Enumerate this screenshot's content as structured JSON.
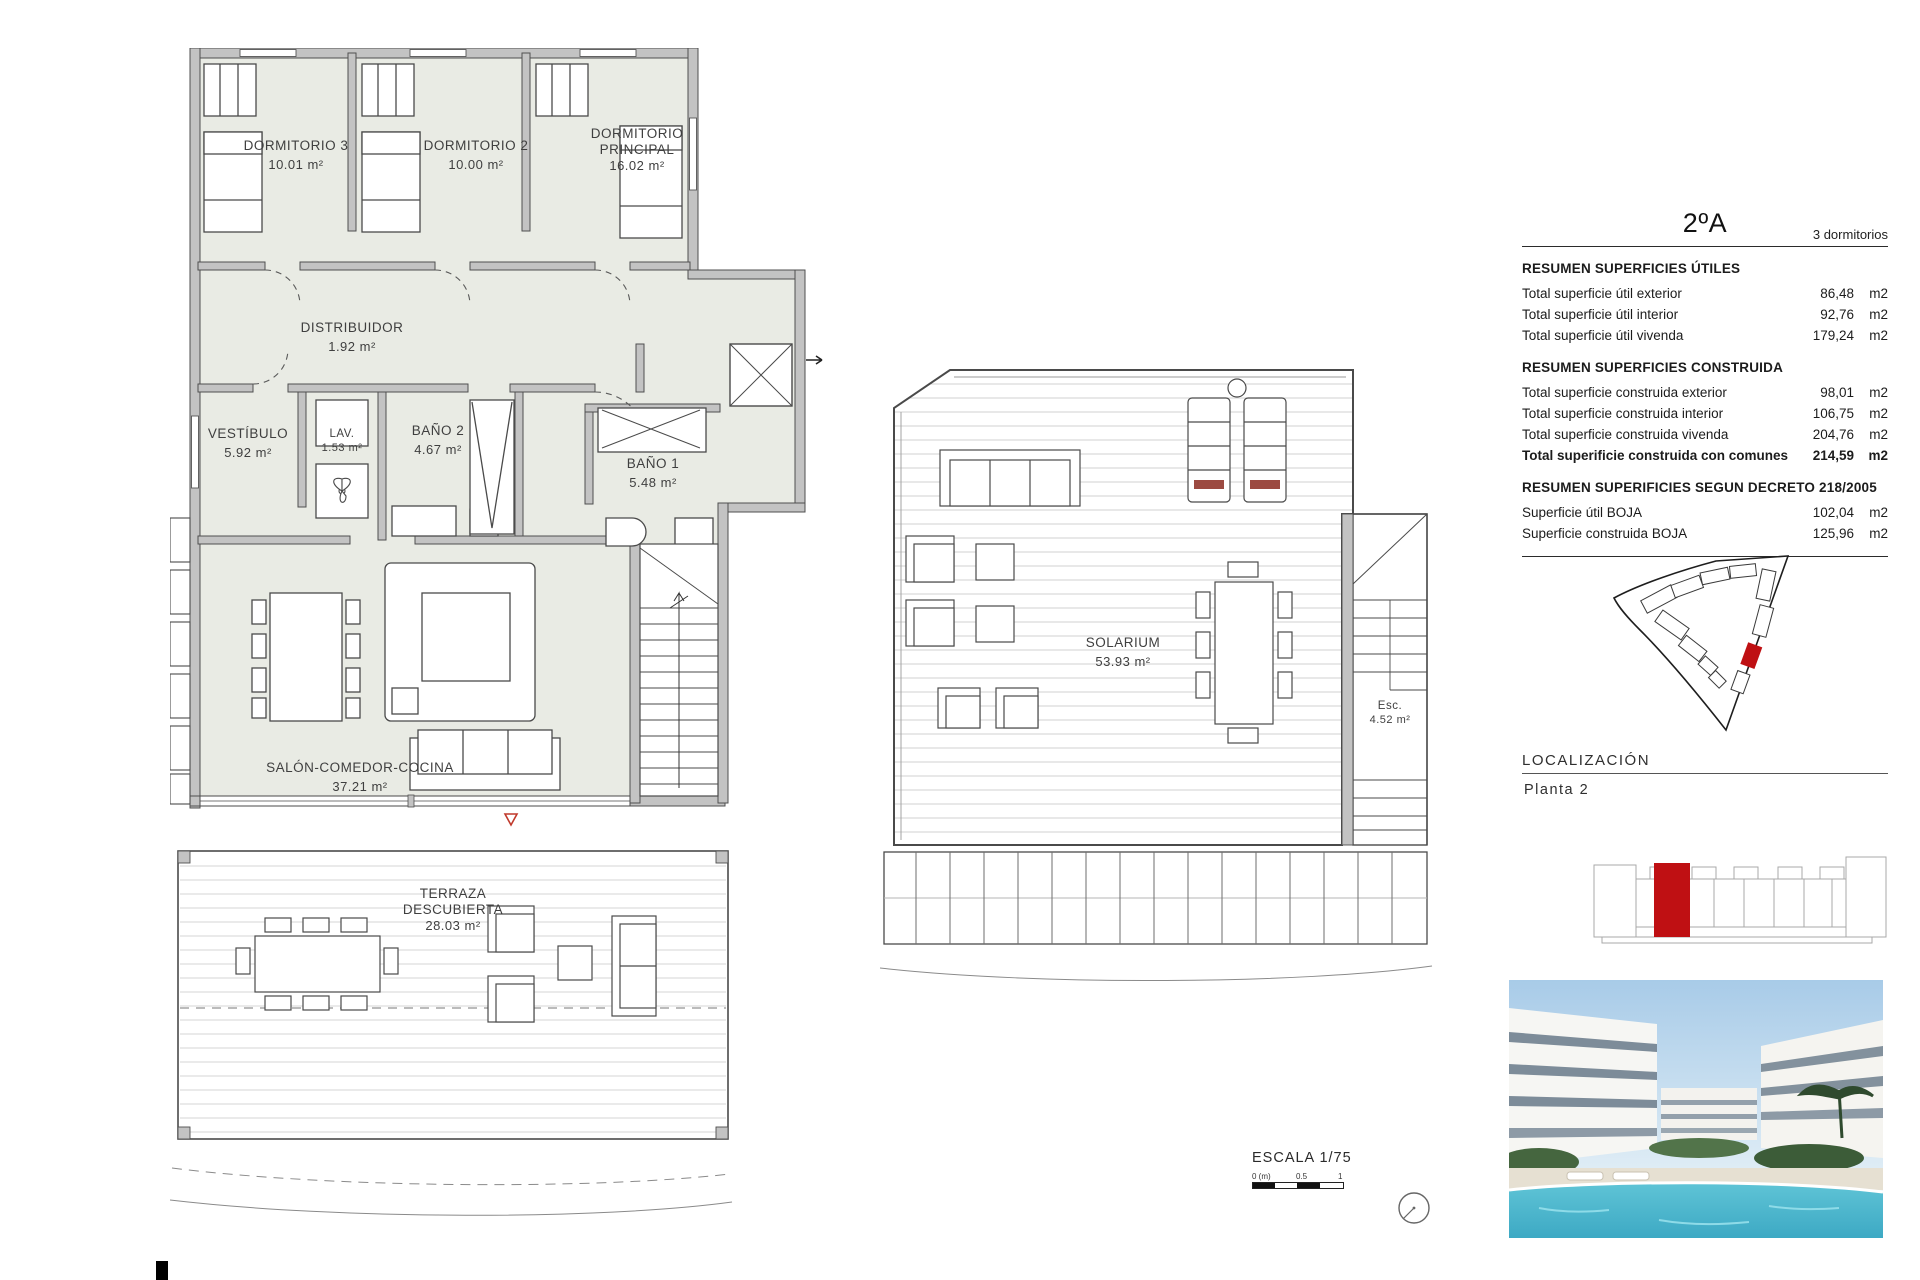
{
  "header": {
    "unit": "2ºA",
    "bedrooms_note": "3 dormitorios"
  },
  "summary": {
    "sections": [
      {
        "heading": "RESUMEN SUPERFICIES ÚTILES",
        "rows": [
          {
            "label": "Total superficie útil exterior",
            "value": "86,48",
            "unit": "m2"
          },
          {
            "label": "Total superficie útil interior",
            "value": "92,76",
            "unit": "m2"
          },
          {
            "label": "Total superficie útil vivenda",
            "value": "179,24",
            "unit": "m2"
          }
        ]
      },
      {
        "heading": "RESUMEN SUPERFICIES CONSTRUIDA",
        "rows": [
          {
            "label": "Total superficie construida exterior",
            "value": "98,01",
            "unit": "m2"
          },
          {
            "label": "Total superficie construida interior",
            "value": "106,75",
            "unit": "m2"
          },
          {
            "label": "Total superficie construida vivenda",
            "value": "204,76",
            "unit": "m2"
          },
          {
            "label": "Total superificie construida con comunes",
            "value": "214,59",
            "unit": "m2"
          }
        ]
      },
      {
        "heading": "RESUMEN SUPERIFICIES SEGUN DECRETO 218/2005",
        "rows": [
          {
            "label": "Superficie útil BOJA",
            "value": "102,04",
            "unit": "m2"
          },
          {
            "label": "Superficie construida BOJA",
            "value": "125,96",
            "unit": "m2"
          }
        ]
      }
    ]
  },
  "localizacion": {
    "heading": "LOCALIZACIÓN",
    "floor": "Planta  2"
  },
  "plan_main": {
    "rooms": [
      {
        "name": "DORMITORIO 3",
        "area": "10.01 m²"
      },
      {
        "name": "DORMITORIO 2",
        "area": "10.00 m²"
      },
      {
        "name": "DORMITORIO PRINCIPAL",
        "area": "16.02 m²"
      },
      {
        "name": "DISTRIBUIDOR",
        "area": "1.92 m²"
      },
      {
        "name": "VESTÍBULO",
        "area": "5.92 m²"
      },
      {
        "name": "LAV.",
        "area": "1.53 m²"
      },
      {
        "name": "BAÑO 2",
        "area": "4.67 m²"
      },
      {
        "name": "BAÑO 1",
        "area": "5.48 m²"
      },
      {
        "name": "SALÓN-COMEDOR-COCINA",
        "area": "37.21 m²"
      },
      {
        "name": "TERRAZA DESCUBIERTA",
        "area": "28.03 m²"
      }
    ]
  },
  "plan_solarium": {
    "rooms": [
      {
        "name": "SOLARIUM",
        "area": "53.93 m²"
      },
      {
        "name": "Esc.",
        "area": "4.52 m²"
      }
    ]
  },
  "scale": {
    "title": "ESCALA 1/75",
    "zero": "0 (m)",
    "half": "0.5",
    "one": "1"
  },
  "colors": {
    "accent_red": "#bf1013",
    "wall_gray": "#c3c3c3",
    "floor_fill": "#e9ebe4",
    "line": "#4a4a4a"
  }
}
